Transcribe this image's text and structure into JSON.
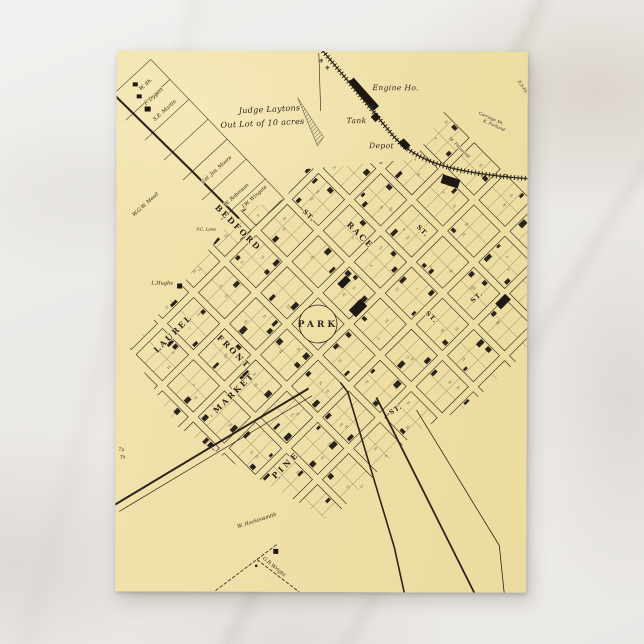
{
  "map": {
    "park": "PARK",
    "railroad_label": "R R",
    "out_lot_line1": "Judge Laytons",
    "out_lot_line2": "Out Lot of 10 acres",
    "poi": {
      "engine_house": "Engine Ho.",
      "tank": "Tank",
      "depot": "Depot"
    },
    "streets": {
      "bedford": "BEDFORD",
      "bedford_st": "ST.",
      "race": "RACE",
      "race_st": "ST.",
      "front": "FRONT",
      "laurel": "LAUREL",
      "market": "MARKET",
      "pine": "PINE",
      "st_a": "ST.",
      "st_b": "ST.",
      "st_c": "ST."
    },
    "names": {
      "w_sh": "W. Sh.",
      "f_dygert": "F. Dygert",
      "se_martin": "S.E. Martin",
      "wgw_mead": "W.G.W. Mead",
      "col_jas_moore": "Col. Jas. Moore",
      "w_robinson": "W. Robinson",
      "jw_wingate": "J.W. Wingate",
      "pc_lane": "P.C. Lane",
      "l_hughs": "L.Hughs",
      "w_hockensmith": "W. Hockensmith",
      "gb_wright": "G.B.Wright",
      "carriage_sh": "Carriage Sh.",
      "k_forhand": "K. Forhand",
      "m_thousand": "M. Thousand",
      "ds_fa": "D.S.Fa.",
      "frag_ty": "Ty,",
      "frag_th": "Th"
    },
    "lot_numbers_sample": [
      "7",
      "8",
      "9",
      "10",
      "12",
      "18",
      "19",
      "20",
      "26",
      "27",
      "78",
      "79"
    ],
    "colors": {
      "paper": "#efe0a8",
      "ink": "#2b241a"
    }
  }
}
